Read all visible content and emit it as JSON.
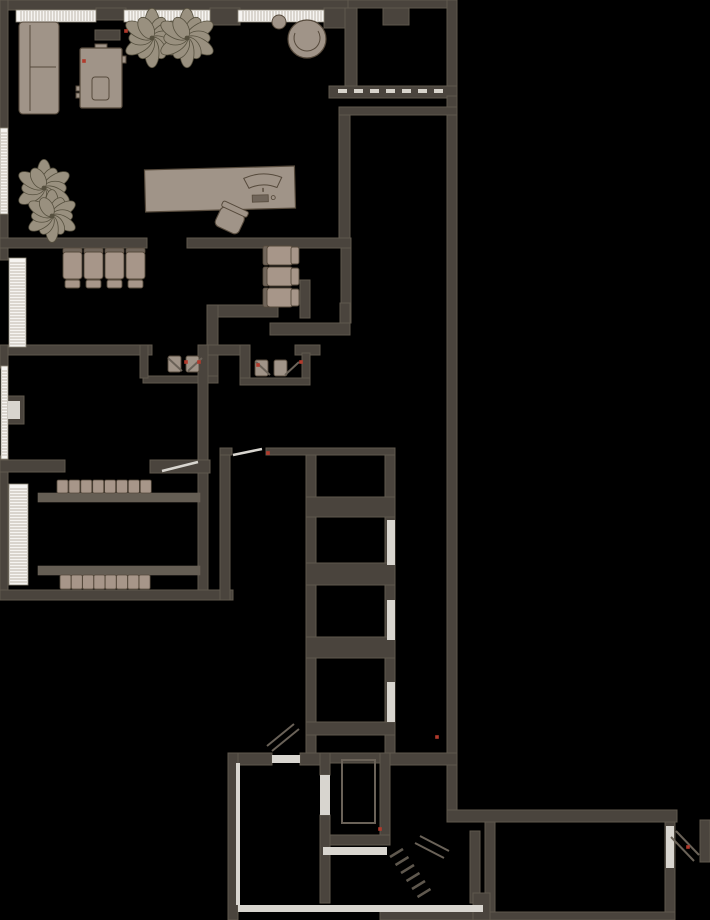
{
  "canvas": {
    "width": 710,
    "height": 920,
    "background": "#000000"
  },
  "palette": {
    "wall": "#4a443d",
    "wallEdge": "#5f584d",
    "wallLight": "#6a6258",
    "counter": "#655e54",
    "furn": "#a09488",
    "furnDark": "#70655a",
    "furnStroke": "#564a3c",
    "seat": "#a79689",
    "plant": "#99907f",
    "plantStroke": "#56503f",
    "windowFill": "#f6f4f1",
    "windowTick": "#a99f90",
    "windowFrame": "#8c8576",
    "light": "#d8d5cf",
    "glaze": "#d8d4cc",
    "red": "#b23a2c",
    "stair": "#5f584e"
  },
  "plan": {
    "walls": [
      [
        0,
        0,
        348,
        10
      ],
      [
        348,
        0,
        109,
        8
      ],
      [
        96,
        8,
        30,
        12
      ],
      [
        210,
        8,
        30,
        17
      ],
      [
        324,
        8,
        26,
        20
      ],
      [
        95,
        30,
        25,
        10
      ],
      [
        447,
        0,
        10,
        96
      ],
      [
        345,
        8,
        12,
        80
      ],
      [
        383,
        8,
        26,
        17
      ],
      [
        329,
        86,
        128,
        12
      ],
      [
        447,
        96,
        10,
        716
      ],
      [
        339,
        107,
        118,
        8
      ],
      [
        339,
        115,
        11,
        133
      ],
      [
        0,
        0,
        8,
        128
      ],
      [
        0,
        214,
        8,
        46
      ],
      [
        0,
        238,
        147,
        10
      ],
      [
        187,
        238,
        164,
        10
      ],
      [
        341,
        248,
        10,
        75
      ],
      [
        207,
        305,
        71,
        12
      ],
      [
        207,
        305,
        11,
        78
      ],
      [
        300,
        280,
        10,
        38
      ],
      [
        270,
        323,
        80,
        12
      ],
      [
        340,
        303,
        10,
        20
      ],
      [
        0,
        345,
        147,
        10
      ],
      [
        0,
        345,
        8,
        23
      ],
      [
        0,
        456,
        8,
        24
      ],
      [
        6,
        396,
        18,
        28
      ],
      [
        140,
        345,
        12,
        10
      ],
      [
        204,
        345,
        36,
        10
      ],
      [
        240,
        345,
        10,
        37
      ],
      [
        295,
        345,
        25,
        10
      ],
      [
        302,
        353,
        8,
        30
      ],
      [
        143,
        376,
        75,
        7
      ],
      [
        240,
        378,
        70,
        7
      ],
      [
        140,
        345,
        8,
        33
      ],
      [
        198,
        345,
        10,
        245
      ],
      [
        0,
        460,
        65,
        12
      ],
      [
        150,
        460,
        60,
        13
      ],
      [
        0,
        472,
        8,
        120
      ],
      [
        0,
        590,
        233,
        10
      ],
      [
        220,
        455,
        10,
        145
      ],
      [
        220,
        448,
        12,
        7
      ],
      [
        266,
        448,
        129,
        7
      ],
      [
        306,
        455,
        10,
        300
      ],
      [
        385,
        455,
        10,
        300
      ],
      [
        306,
        497,
        89,
        20
      ],
      [
        306,
        563,
        89,
        22
      ],
      [
        306,
        637,
        89,
        21
      ],
      [
        306,
        722,
        89,
        13
      ],
      [
        390,
        753,
        67,
        12
      ],
      [
        228,
        753,
        44,
        12
      ],
      [
        300,
        753,
        30,
        12
      ],
      [
        228,
        753,
        10,
        167
      ],
      [
        320,
        753,
        10,
        22
      ],
      [
        320,
        815,
        10,
        88
      ],
      [
        330,
        753,
        60,
        10
      ],
      [
        380,
        753,
        10,
        92
      ],
      [
        330,
        835,
        60,
        10
      ],
      [
        447,
        810,
        230,
        12
      ],
      [
        485,
        822,
        10,
        98
      ],
      [
        665,
        822,
        10,
        98
      ],
      [
        485,
        912,
        190,
        8
      ],
      [
        700,
        820,
        10,
        42
      ],
      [
        380,
        908,
        103,
        12
      ],
      [
        470,
        831,
        10,
        72
      ],
      [
        473,
        893,
        17,
        27
      ]
    ],
    "shaft_inner": [
      342,
      760,
      33,
      63
    ],
    "light_rects": [
      [
        272,
        755,
        28,
        8
      ],
      [
        320,
        775,
        10,
        40
      ],
      [
        387,
        520,
        8,
        45
      ],
      [
        387,
        600,
        8,
        40
      ],
      [
        387,
        682,
        8,
        40
      ],
      [
        323,
        847,
        64,
        8
      ],
      [
        666,
        826,
        8,
        42
      ],
      [
        238,
        905,
        245,
        7
      ],
      [
        236,
        763,
        4,
        142
      ],
      [
        8,
        401,
        12,
        18
      ]
    ],
    "glaze_dashes": {
      "x": 338,
      "y": 89,
      "count": 7,
      "step": 16,
      "w": 9,
      "h": 4
    },
    "windows": [
      {
        "x": 16,
        "y": 10,
        "w": 80,
        "h": 12,
        "dir": "h"
      },
      {
        "x": 124,
        "y": 10,
        "w": 86,
        "h": 12,
        "dir": "h"
      },
      {
        "x": 238,
        "y": 10,
        "w": 86,
        "h": 12,
        "dir": "h"
      },
      {
        "x": 0,
        "y": 128,
        "w": 8,
        "h": 86,
        "dir": "v"
      },
      {
        "x": 9,
        "y": 258,
        "w": 17,
        "h": 89,
        "dir": "v"
      },
      {
        "x": 1,
        "y": 366,
        "w": 7,
        "h": 93,
        "dir": "v"
      },
      {
        "x": 9,
        "y": 484,
        "w": 19,
        "h": 101,
        "dir": "v"
      }
    ],
    "plants": [
      [
        152,
        38,
        27
      ],
      [
        187,
        38,
        27
      ],
      [
        44,
        188,
        26
      ],
      [
        52,
        216,
        24
      ]
    ],
    "sofa": {
      "x": 19,
      "y": 22,
      "w": 40,
      "h": 92,
      "backX": 30,
      "divY": 67
    },
    "stove": {
      "x": 80,
      "y": 48,
      "w": 42,
      "h": 60,
      "inner": [
        92,
        77,
        17,
        23
      ],
      "top": [
        95,
        44,
        12,
        6
      ],
      "tabs": [
        [
          76,
          86,
          8,
          5
        ],
        [
          76,
          93,
          8,
          5
        ],
        [
          120,
          56,
          6,
          7
        ]
      ]
    },
    "side_table": {
      "cx": 279,
      "cy": 22,
      "r": 7
    },
    "armchair": {
      "cx": 307,
      "cy": 39,
      "r": 19
    },
    "desk": {
      "x": 145,
      "y": 168,
      "w": 150,
      "h": 42,
      "rot": -1.5,
      "monitor": {
        "cx": 263,
        "y": 179
      },
      "keyboard": [
        252,
        196,
        16,
        7
      ],
      "mouse": [
        273,
        199
      ]
    },
    "office_chair": {
      "cx": 230,
      "cy": 220,
      "rot": 25
    },
    "seat_row": {
      "x": 63,
      "y": 248,
      "count": 4,
      "w": 19,
      "step": 21
    },
    "seat_col": {
      "x": 263,
      "y": 246,
      "count": 3,
      "h": 19,
      "step": 21
    },
    "classroom": {
      "counters": [
        [
          38,
          493,
          162,
          9
        ],
        [
          38,
          566,
          162,
          9
        ]
      ],
      "chair_rows": [
        {
          "x": 57,
          "y": 480,
          "count": 8,
          "w": 11,
          "h": 13,
          "step": 11.9
        },
        {
          "x": 60,
          "y": 575,
          "count": 8,
          "w": 11,
          "h": 14,
          "step": 11.3
        }
      ]
    },
    "wc_fixtures": [
      [
        168,
        356,
        13,
        16
      ],
      [
        186,
        356,
        13,
        16
      ],
      [
        255,
        360,
        13,
        16
      ],
      [
        274,
        360,
        13,
        16
      ]
    ],
    "door_glyphs": [
      {
        "pts": [
          [
            162,
            471
          ],
          [
            198,
            462
          ]
        ],
        "tone": "light"
      },
      {
        "pts": [
          [
            233,
            455
          ],
          [
            262,
            449
          ]
        ],
        "tone": "light"
      },
      {
        "pts": [
          [
            272,
            751
          ],
          [
            299,
            729
          ]
        ],
        "tone": "dark"
      },
      {
        "pts": [
          [
            267,
            746
          ],
          [
            294,
            724
          ]
        ],
        "tone": "dark"
      },
      {
        "pts": [
          [
            420,
            836
          ],
          [
            449,
            851
          ]
        ],
        "tone": "dark"
      },
      {
        "pts": [
          [
            415,
            843
          ],
          [
            444,
            858
          ]
        ],
        "tone": "dark"
      },
      {
        "pts": [
          [
            676,
            831
          ],
          [
            699,
            855
          ]
        ],
        "tone": "dark"
      },
      {
        "pts": [
          [
            671,
            837
          ],
          [
            694,
            861
          ]
        ],
        "tone": "dark"
      },
      {
        "pts": [
          [
            168,
            358
          ],
          [
            182,
            371
          ]
        ],
        "tone": "dark"
      },
      {
        "pts": [
          [
            202,
            358
          ],
          [
            188,
            371
          ]
        ],
        "tone": "dark"
      },
      {
        "pts": [
          [
            256,
            362
          ],
          [
            270,
            375
          ]
        ],
        "tone": "dark"
      },
      {
        "pts": [
          [
            299,
            362
          ],
          [
            285,
            375
          ]
        ],
        "tone": "dark"
      }
    ],
    "stairs": {
      "x": 390,
      "y": 857,
      "steps": 6,
      "dx": 5.5,
      "dy": 8,
      "len": 13,
      "rise": 8
    },
    "red_markers": [
      [
        126,
        31
      ],
      [
        84,
        61
      ],
      [
        268,
        453
      ],
      [
        186,
        362
      ],
      [
        199,
        362
      ],
      [
        258,
        365
      ],
      [
        301,
        362
      ],
      [
        380,
        829
      ],
      [
        437,
        737
      ],
      [
        688,
        847
      ]
    ]
  }
}
